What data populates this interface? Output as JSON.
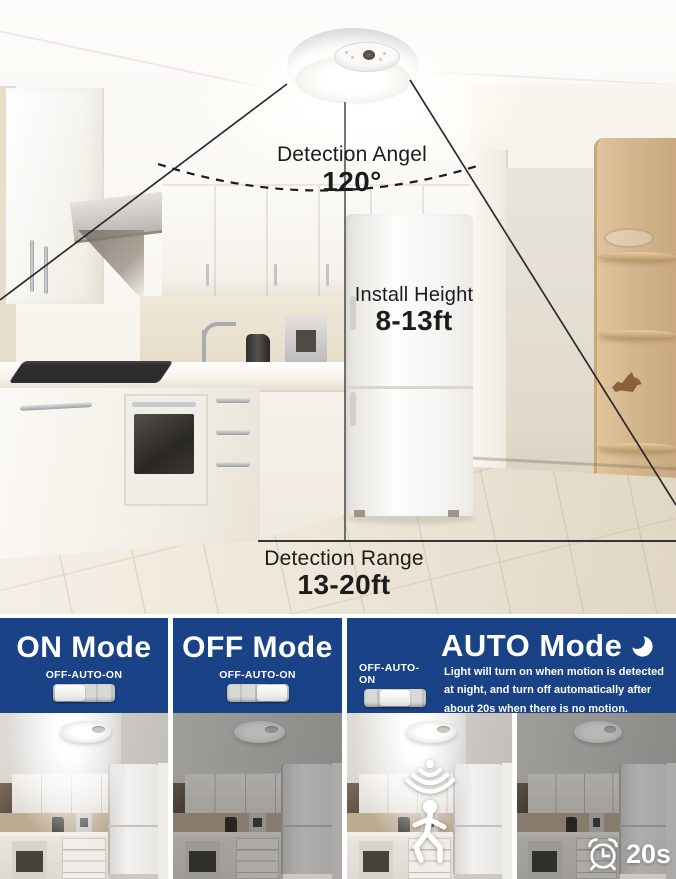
{
  "main": {
    "detection_angle": {
      "label": "Detection Angel",
      "value": "120°"
    },
    "install_height": {
      "label": "Install Height",
      "value": "8-13ft"
    },
    "detection_range": {
      "label": "Detection Range",
      "value": "13-20ft"
    }
  },
  "panels": [
    {
      "title": "ON Mode",
      "switch_label": "OFF-AUTO-ON",
      "switch_position": "on"
    },
    {
      "title": "OFF Mode",
      "switch_label": "OFF-AUTO-ON",
      "switch_position": "off"
    },
    {
      "title": "AUTO Mode",
      "switch_label": "OFF-AUTO-ON",
      "switch_position": "auto",
      "moon_icon": "crescent-moon-icon",
      "description": "Light will turn on when motion is detected at night, and turn off automatically after about 20s when there is no motion.",
      "timer_badge": "20s"
    }
  ],
  "icons": {
    "motion": "motion-sensor-walking-person-icon",
    "clock": "alarm-clock-icon"
  },
  "colors": {
    "panel_blue": "#1a4287",
    "annotation_black": "#1c1c1c",
    "white": "#ffffff"
  }
}
